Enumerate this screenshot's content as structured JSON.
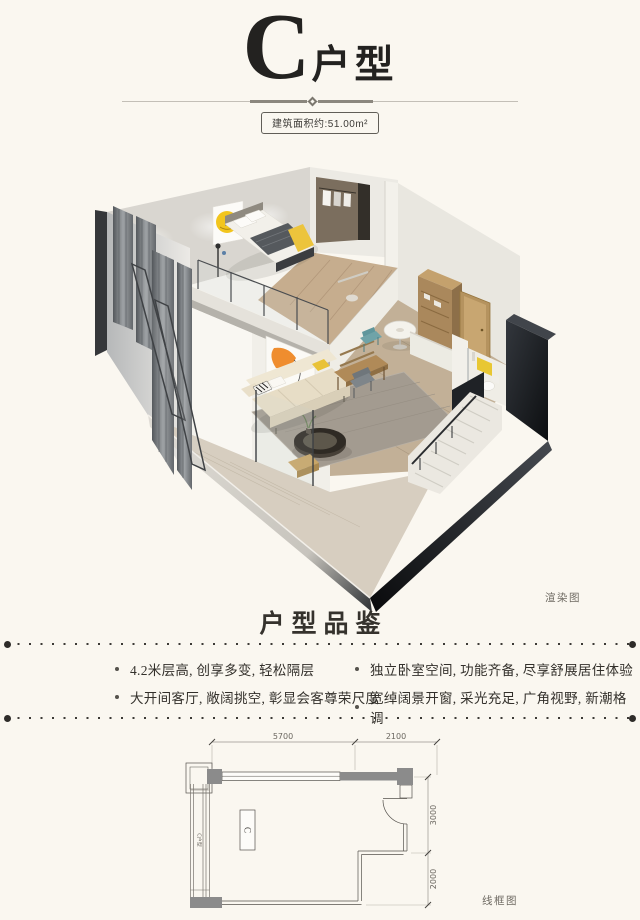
{
  "header": {
    "unit_letter": "C",
    "unit_suffix": "户型",
    "area_badge": "建筑面积约:51.00m²"
  },
  "render": {
    "caption": "渲染图"
  },
  "features": {
    "title": "户型品鉴",
    "items": [
      "4.2米层高, 创享多变, 轻松隔层",
      "独立卧室空间, 功能齐备, 尽享舒展居住体验",
      "大开间客厅, 敞阔挑空, 彰显会客尊荣尺度",
      "宽绰阔景开窗, 采光充足, 广角视野, 新潮格调"
    ]
  },
  "floorplan": {
    "caption": "线框图",
    "unit_label": "C",
    "side_label": "C户型",
    "dim_top": [
      "5700",
      "2100"
    ],
    "dim_right": [
      "3000",
      "2000"
    ]
  },
  "colors": {
    "background": "#faf7f0",
    "ink": "#2b2824",
    "accent_yellow": "#f2c51d",
    "teal_chair": "#6fa3a8",
    "wood": "#b99a6d",
    "wall_gray": "#d8d5d0",
    "dark_wall": "#17191c"
  }
}
